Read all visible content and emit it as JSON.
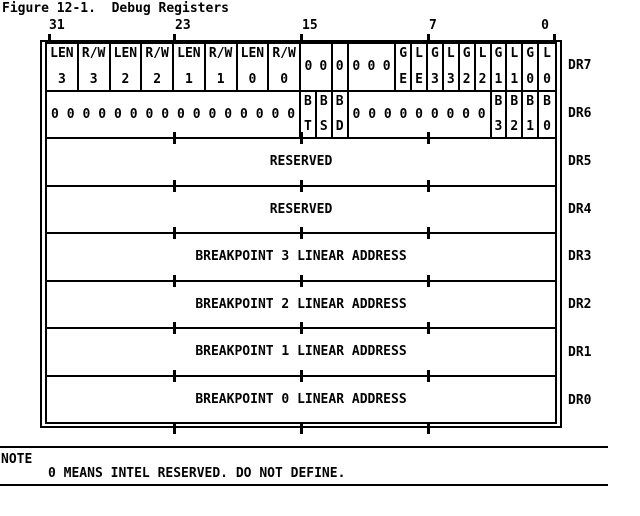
{
  "title": "Figure 12-1.  Debug Registers",
  "bit_labels": [
    "31",
    "23",
    "15",
    "7",
    "0"
  ],
  "zero_char": "0",
  "colors": {
    "ink": "#000000",
    "paper": "#ffffff"
  },
  "registers": [
    {
      "name": "DR7",
      "byte_ticks": false,
      "cells": [
        {
          "top": "LEN",
          "bottom": "3",
          "bits": 2
        },
        {
          "top": "R/W",
          "bottom": "3",
          "bits": 2
        },
        {
          "top": "LEN",
          "bottom": "2",
          "bits": 2
        },
        {
          "top": "R/W",
          "bottom": "2",
          "bits": 2
        },
        {
          "top": "LEN",
          "bottom": "1",
          "bits": 2
        },
        {
          "top": "R/W",
          "bottom": "1",
          "bits": 2
        },
        {
          "top": "LEN",
          "bottom": "0",
          "bits": 2
        },
        {
          "top": "R/W",
          "bottom": "0",
          "bits": 2
        },
        {
          "zeros": 2,
          "bits": 2
        },
        {
          "zeros": 1,
          "bits": 1
        },
        {
          "zeros": 3,
          "bits": 3
        },
        {
          "top": "G",
          "bottom": "E",
          "bits": 1
        },
        {
          "top": "L",
          "bottom": "E",
          "bits": 1
        },
        {
          "top": "G",
          "bottom": "3",
          "bits": 1
        },
        {
          "top": "L",
          "bottom": "3",
          "bits": 1
        },
        {
          "top": "G",
          "bottom": "2",
          "bits": 1
        },
        {
          "top": "L",
          "bottom": "2",
          "bits": 1
        },
        {
          "top": "G",
          "bottom": "1",
          "bits": 1
        },
        {
          "top": "L",
          "bottom": "1",
          "bits": 1
        },
        {
          "top": "G",
          "bottom": "0",
          "bits": 1
        },
        {
          "top": "L",
          "bottom": "0",
          "bits": 1
        }
      ]
    },
    {
      "name": "DR6",
      "byte_ticks": false,
      "cells": [
        {
          "zeros": 16,
          "bits": 16
        },
        {
          "top": "B",
          "bottom": "T",
          "bits": 1
        },
        {
          "top": "B",
          "bottom": "S",
          "bits": 1
        },
        {
          "top": "B",
          "bottom": "D",
          "bits": 1
        },
        {
          "zeros": 9,
          "bits": 9
        },
        {
          "top": "B",
          "bottom": "3",
          "bits": 1
        },
        {
          "top": "B",
          "bottom": "2",
          "bits": 1
        },
        {
          "top": "B",
          "bottom": "1",
          "bits": 1
        },
        {
          "top": "B",
          "bottom": "0",
          "bits": 1
        }
      ]
    },
    {
      "name": "DR5",
      "label": "RESERVED",
      "byte_ticks": true
    },
    {
      "name": "DR4",
      "label": "RESERVED",
      "byte_ticks": true
    },
    {
      "name": "DR3",
      "label": "BREAKPOINT 3 LINEAR ADDRESS",
      "byte_ticks": true
    },
    {
      "name": "DR2",
      "label": "BREAKPOINT 2 LINEAR ADDRESS",
      "byte_ticks": true
    },
    {
      "name": "DR1",
      "label": "BREAKPOINT 1 LINEAR ADDRESS",
      "byte_ticks": true
    },
    {
      "name": "DR0",
      "label": "BREAKPOINT 0 LINEAR ADDRESS",
      "byte_ticks": true
    }
  ],
  "note": {
    "heading": "NOTE",
    "text": "0 MEANS INTEL RESERVED. DO NOT DEFINE."
  }
}
